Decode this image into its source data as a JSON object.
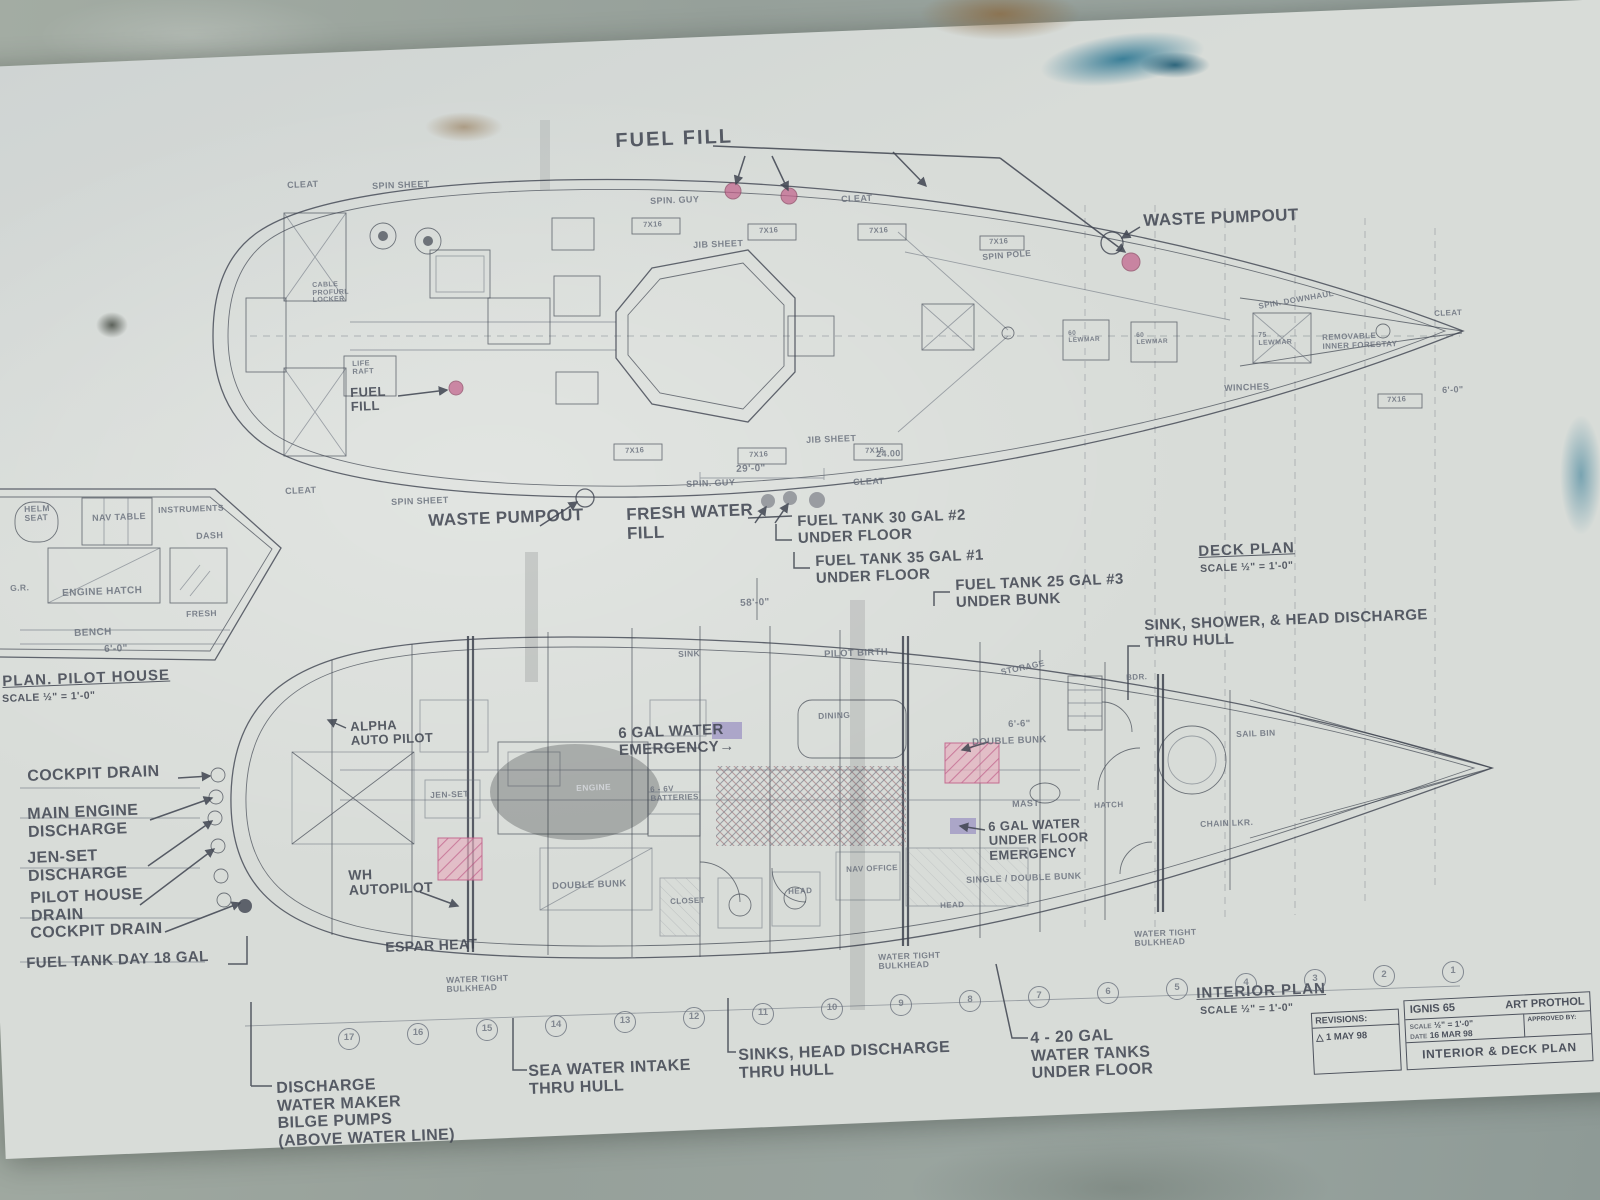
{
  "colors": {
    "concrete": "#9aa49d",
    "paper": "#d8dcd8",
    "ink": "#3f4450",
    "pencil": "#646b78",
    "pink": "#c2608a",
    "pink_fill": "#e7b0c0",
    "purple": "#998fc2",
    "stain_blue": "#2a7591",
    "stain_brown": "#8a6a42"
  },
  "deck_plan": {
    "caption": "DECK PLAN",
    "scale": "SCALE ½\" = 1'-0\"",
    "fuel_fill": "FUEL FILL",
    "fuel_fill_side": "FUEL\nFILL",
    "waste_pumpout": "WASTE PUMPOUT",
    "waste_pumpout_aft": "WASTE PUMPOUT",
    "fresh_water_fill": "FRESH WATER\nFILL",
    "labels": {
      "cleat": "CLEAT",
      "spin_sheet": "SPIN SHEET",
      "spin_guy": "SPIN. GUY",
      "jib_sheet": "JIB SHEET",
      "track": "7X16",
      "hatch60": "60 LEWMAR",
      "hatch75": "75 LEWMAR",
      "spin_downhaul": "SPIN. DOWNHAUL",
      "spin_pole": "SPIN POLE",
      "life_raft": "LIFE\nRAFT",
      "locker": "CABLE\nPROFURL\nLOCKER",
      "forestay": "REMOVABLE\nINNER FORESTAY",
      "winches": "WINCHES"
    },
    "dims": {
      "d29": "29'-0\"",
      "d58": "58'-0\"",
      "d2400": "24.00",
      "d60": "6'-0\"",
      "d66": "6'-6\""
    }
  },
  "fuel_tanks": {
    "t2": "FUEL TANK 30 GAL #2\nUNDER FLOOR",
    "t1": "FUEL TANK 35 GAL #1\nUNDER FLOOR",
    "t3": "FUEL TANK 25 GAL #3\nUNDER BUNK"
  },
  "discharge_note": "SINK, SHOWER, & HEAD DISCHARGE\nTHRU HULL",
  "pilot_house": {
    "caption": "PLAN. PILOT HOUSE",
    "scale": "SCALE ½\" = 1'-0\"",
    "helm_seat": "HELM\nSEAT",
    "nav_table": "NAV TABLE",
    "instruments": "INSTRUMENTS",
    "dash": "DASH",
    "engine_hatch": "ENGINE HATCH",
    "bench": "BENCH",
    "dim": "6'-0\"",
    "fresh": "FRESH",
    "gr": "G.R."
  },
  "left_callouts": {
    "cockpit_drain": "COCKPIT DRAIN",
    "main_engine": "MAIN ENGINE\nDISCHARGE",
    "jen_set": "JEN-SET\nDISCHARGE",
    "pilot_house_drain": "PILOT HOUSE\nDRAIN",
    "cockpit_drain2": "COCKPIT DRAIN",
    "fuel_day": "FUEL TANK DAY 18 GAL"
  },
  "interior_plan": {
    "caption": "INTERIOR PLAN",
    "scale": "SCALE ½\" = 1'-0\"",
    "alpha": "ALPHA\nAUTO PILOT",
    "water6": "6 GAL WATER\nEMERGENCY→",
    "wh": "WH\nAUTOPILOT",
    "espar": "ESPAR HEAT",
    "water6_floor": "6 GAL WATER\nUNDER FLOOR\nEMERGENCY",
    "wt_bulkhead": "WATER TIGHT\nBULKHEAD",
    "rooms": {
      "sink": "SINK",
      "pilot_berth": "PILOT BIRTH",
      "storage": "STORAGE",
      "dining": "DINING",
      "double_bunk": "DOUBLE BUNK",
      "mast": "MAST",
      "single_double": "SINGLE / DOUBLE BUNK",
      "nav_office": "NAV OFFICE",
      "head": "HEAD",
      "closet": "CLOSET",
      "double_bunk2": "DOUBLE BUNK",
      "jen_set": "JEN-SET",
      "engine": "ENGINE",
      "batteries": "6 - 6V\nBATTERIES",
      "hatch": "HATCH",
      "sail_bin": "SAIL BIN",
      "chain_lkr": "CHAIN LKR.",
      "bdr": "BDR."
    },
    "stations": [
      "17",
      "16",
      "15",
      "14",
      "13",
      "12",
      "11",
      "10",
      "9",
      "8",
      "7",
      "6",
      "5",
      "4",
      "3",
      "2",
      "1"
    ]
  },
  "bottom_callouts": {
    "discharge": "DISCHARGE\nWATER MAKER\nBILGE PUMPS\n(ABOVE WATER LINE)",
    "sea_water": "SEA WATER INTAKE\nTHRU HULL",
    "sinks": "SINKS, HEAD DISCHARGE\nTHRU HULL",
    "tanks": "4 - 20 GAL\nWATER TANKS\nUNDER FLOOR"
  },
  "title_block": {
    "revisions": "REVISIONS:",
    "rev1": "△  1 MAY 98",
    "project": "IGNIS 65",
    "designer": "ART PROTHOL",
    "scale_label": "SCALE",
    "scale_value": "½\" = 1'-0\"",
    "date_label": "DATE",
    "date_value": "16 MAR 98",
    "approved": "APPROVED BY:",
    "sheet": "INTERIOR & DECK PLAN"
  }
}
